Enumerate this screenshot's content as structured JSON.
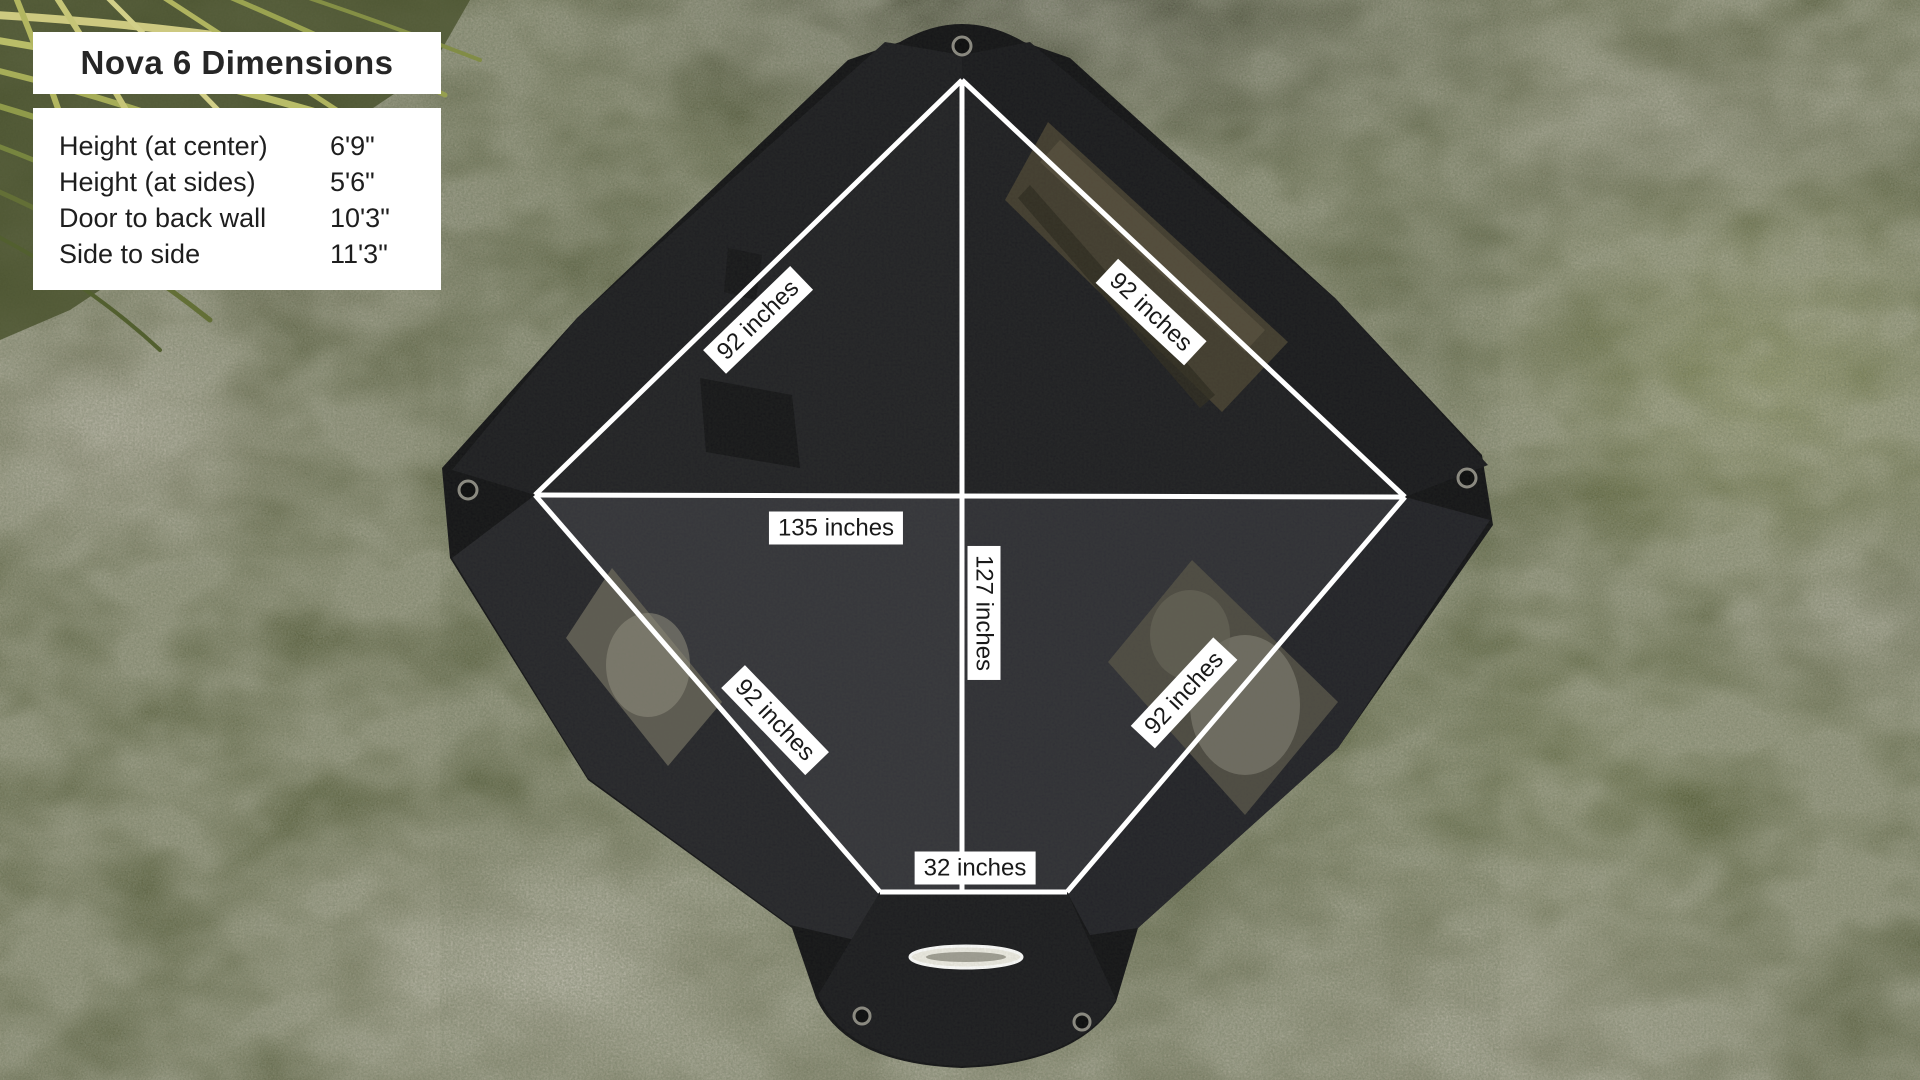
{
  "card": {
    "title": "Nova 6 Dimensions",
    "rows": [
      {
        "label": "Height (at center)",
        "value": "6'9\""
      },
      {
        "label": "Height (at sides)",
        "value": "5'6\""
      },
      {
        "label": "Door to back wall",
        "value": "10'3\""
      },
      {
        "label": "Side to side",
        "value": "11'3\""
      }
    ]
  },
  "measurements": {
    "edge_top_left": "92 inches",
    "edge_top_right": "92 inches",
    "edge_bottom_left": "92 inches",
    "edge_bottom_right": "92 inches",
    "width": "135 inches",
    "depth": "127 inches",
    "door_width": "32 inches"
  },
  "colors": {
    "measure_line": "#ffffff",
    "label_background": "#ffffff",
    "label_text": "#191919",
    "tent_fabric": "#1d1d21"
  }
}
